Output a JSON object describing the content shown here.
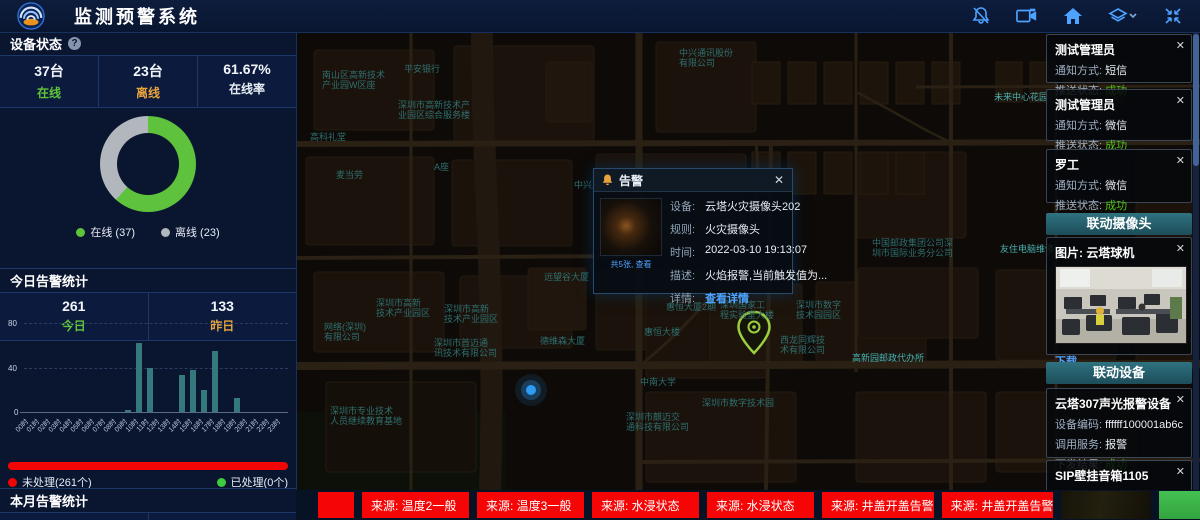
{
  "header": {
    "title": "监测预警系统",
    "icons": [
      {
        "name": "bell-off-icon"
      },
      {
        "name": "video-camera-icon"
      },
      {
        "name": "home-icon"
      },
      {
        "name": "layers-icon"
      },
      {
        "name": "fullscreen-icon"
      }
    ]
  },
  "device_status": {
    "title": "设备状态",
    "help": "?",
    "stats": [
      {
        "value": "37台",
        "label": "在线",
        "color": "#5fc43a"
      },
      {
        "value": "23台",
        "label": "离线",
        "color": "#e8a33d"
      },
      {
        "value": "61.67%",
        "label": "在线率",
        "color": "#e8eef5"
      }
    ],
    "legend": [
      {
        "label": "在线 (37)",
        "color": "#5ec23c"
      },
      {
        "label": "离线 (23)",
        "color": "#b2b6bd"
      }
    ]
  },
  "today_alarms": {
    "title": "今日告警统计",
    "stats": [
      {
        "value": "261",
        "label": "今日",
        "color": "#5fc43a"
      },
      {
        "value": "133",
        "label": "昨日",
        "color": "#e8a33d"
      }
    ],
    "progress": {
      "unhandled": {
        "label": "未处理(261个)",
        "color": "#f20505"
      },
      "handled": {
        "label": "已处理(0个)",
        "color": "#3ecb3e"
      }
    }
  },
  "month_alarms": {
    "title": "本月告警统计",
    "values": [
      "763",
      "1146"
    ]
  },
  "chart_data": [
    {
      "type": "pie",
      "title": "设备状态",
      "labels": [
        "在线",
        "离线"
      ],
      "values": [
        37,
        23
      ],
      "colors": [
        "#5ec23c",
        "#b2b6bd"
      ],
      "donut": true,
      "online_rate": "61.67%"
    },
    {
      "type": "bar",
      "title": "今日告警统计(按小时)",
      "categories": [
        "00时",
        "01时",
        "02时",
        "03时",
        "04时",
        "05时",
        "06时",
        "07时",
        "08时",
        "09时",
        "10时",
        "11时",
        "12时",
        "13时",
        "14时",
        "15时",
        "16时",
        "17时",
        "18时",
        "19时",
        "20时",
        "21时",
        "22时",
        "23时"
      ],
      "values": [
        0,
        0,
        0,
        0,
        0,
        0,
        0,
        0,
        0,
        2,
        62,
        40,
        0,
        0,
        33,
        38,
        20,
        55,
        0,
        13,
        0,
        0,
        0,
        0
      ],
      "ylim": [
        0,
        80
      ],
      "yticks": [
        0,
        40,
        80
      ],
      "bar_color": "#35797d",
      "grid": "dashed"
    }
  ],
  "map": {
    "labels": [
      {
        "t": "中兴通讯股份\n有限公司",
        "x": 383,
        "y": 16
      },
      {
        "t": "平安银行",
        "x": 108,
        "y": 32
      },
      {
        "t": "南山区高新技术\n产业园W区座",
        "x": 26,
        "y": 38
      },
      {
        "t": "深圳市高新技术产\n业园区综合服务楼",
        "x": 102,
        "y": 68
      },
      {
        "t": "高科礼堂",
        "x": 14,
        "y": 100
      },
      {
        "t": "麦当劳",
        "x": 40,
        "y": 138
      },
      {
        "t": "A座",
        "x": 138,
        "y": 130
      },
      {
        "t": "未来中心花园",
        "x": 698,
        "y": 60,
        "b": true
      },
      {
        "t": "中兴工业园",
        "x": 278,
        "y": 148
      },
      {
        "t": "深圳市高新\n技术产业园区",
        "x": 80,
        "y": 266
      },
      {
        "t": "深圳市高新\n技术产业园区",
        "x": 148,
        "y": 272
      },
      {
        "t": "网络(深圳)\n有限公司",
        "x": 28,
        "y": 290
      },
      {
        "t": "深圳市首迈通\n讯技术有限公司",
        "x": 138,
        "y": 306
      },
      {
        "t": "深圳市专业技术\n人员继续教育基地",
        "x": 34,
        "y": 374
      },
      {
        "t": "远望谷大厦",
        "x": 248,
        "y": 240
      },
      {
        "t": "德维森大厦",
        "x": 244,
        "y": 304
      },
      {
        "t": "惠恒大厦2期",
        "x": 370,
        "y": 270
      },
      {
        "t": "惠恒大楼",
        "x": 348,
        "y": 295
      },
      {
        "t": "深圳国家工\n程实验室大楼",
        "x": 424,
        "y": 268
      },
      {
        "t": "深圳市数字\n技术园园区",
        "x": 500,
        "y": 268
      },
      {
        "t": "西龙同辉技\n术有限公司",
        "x": 484,
        "y": 303
      },
      {
        "t": "高新园邮政代办所",
        "x": 556,
        "y": 321,
        "b": true
      },
      {
        "t": "中南大学",
        "x": 344,
        "y": 345
      },
      {
        "t": "深圳市数字技术园",
        "x": 406,
        "y": 366
      },
      {
        "t": "深圳市麒迈交\n通科技有限公司",
        "x": 330,
        "y": 380
      },
      {
        "t": "中国邮政集团公司深\n圳市国际业务分公司",
        "x": 576,
        "y": 206
      },
      {
        "t": "友住电脑维修",
        "x": 704,
        "y": 212,
        "b": true
      }
    ]
  },
  "popup": {
    "title": "告警",
    "close": "✕",
    "thumb_caption": "共5张, 查看",
    "fields": [
      {
        "label": "设备:",
        "value": "云塔火灾摄像头202"
      },
      {
        "label": "规则:",
        "value": "火灾摄像头"
      },
      {
        "label": "时间:",
        "value": "2022-03-10 19:13:07"
      },
      {
        "label": "描述:",
        "value": "火焰报警,当前触发值为..."
      },
      {
        "label": "详情:",
        "value": "查看详情",
        "link": true
      }
    ]
  },
  "right_panel": {
    "notifications": [
      {
        "name": "测试管理员",
        "close": "✕",
        "fields": [
          {
            "label": "通知方式:",
            "value": "短信"
          },
          {
            "label": "推送状态:",
            "value": "成功",
            "success": true
          }
        ]
      },
      {
        "name": "测试管理员",
        "close": "✕",
        "fields": [
          {
            "label": "通知方式:",
            "value": "微信"
          },
          {
            "label": "推送状态:",
            "value": "成功",
            "success": true
          }
        ]
      },
      {
        "name": "罗工",
        "close": "✕",
        "fields": [
          {
            "label": "通知方式:",
            "value": "微信"
          },
          {
            "label": "推送状态:",
            "value": "成功",
            "success": true
          }
        ]
      }
    ],
    "camera_section": {
      "header": "联动摄像头",
      "card_title": "图片: 云塔球机",
      "close": "✕",
      "download": "下载"
    },
    "device_section": {
      "header": "联动设备",
      "cards": [
        {
          "title": "云塔307声光报警设备",
          "close": "✕",
          "fields": [
            {
              "label": "设备编码:",
              "value": "ffffff100001ab6c"
            },
            {
              "label": "调用服务:",
              "value": "报警"
            },
            {
              "label": "下发结果:",
              "value": "成功",
              "success": true
            }
          ]
        },
        {
          "title": "SIP壁挂音箱1105",
          "close": "✕",
          "fields": [
            {
              "label": "设备编码:",
              "value": "1105"
            }
          ]
        }
      ]
    }
  },
  "ticker": {
    "items": [
      "",
      "来源: 温度2一般",
      "来源: 温度3一般",
      "来源: 水浸状态",
      "来源: 水浸状态",
      "来源: 井盖开盖告警",
      "来源: 井盖开盖告警"
    ]
  }
}
